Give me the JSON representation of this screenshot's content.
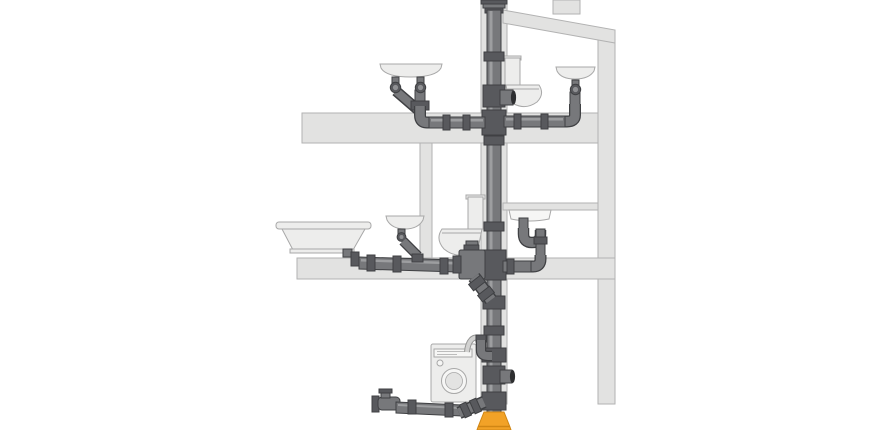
{
  "scene": {
    "kind": "plumbing-drainage-cross-section-illustration",
    "background": "#ffffff",
    "visible_text": []
  },
  "colors": {
    "background": "#ffffff",
    "structure_fill": "#e2e2e1",
    "structure_stroke": "#b2b2b2",
    "fixture_fill": "#ededec",
    "fixture_stroke": "#a8a8a8",
    "fixture_inner": "#f6f6f5",
    "pipe_fill": "#77787b",
    "pipe_stroke": "#3f4043",
    "pipe_highlight": "#a3a4a7",
    "coupling_fill": "#58595d",
    "socket_dark": "#2d2e30",
    "hose_fill": "#d2d2d1",
    "hose_stroke": "#969695",
    "adapter_orange": "#f2a227",
    "adapter_orange_dark": "#d08614"
  },
  "components": [
    "roof",
    "roof-step",
    "right-wall",
    "stack-wall",
    "interior-wall",
    "top-floor-slab",
    "middle-floor-slab",
    "vent-cap",
    "soil-stack",
    "upper-washbasin-double",
    "upper-toilet",
    "upper-washbasin-right",
    "upper-floor-branch-left",
    "upper-floor-branch-right",
    "bathtub",
    "middle-washbasin",
    "middle-toilet",
    "kitchen-sink",
    "kitchen-trap",
    "middle-floor-branch",
    "toilet-connector",
    "offset-bend",
    "washing-machine",
    "washing-machine-hose",
    "washer-standpipe",
    "side-inlet-tee",
    "cleanout-pipe",
    "base-coupling",
    "sewer-adapter"
  ]
}
